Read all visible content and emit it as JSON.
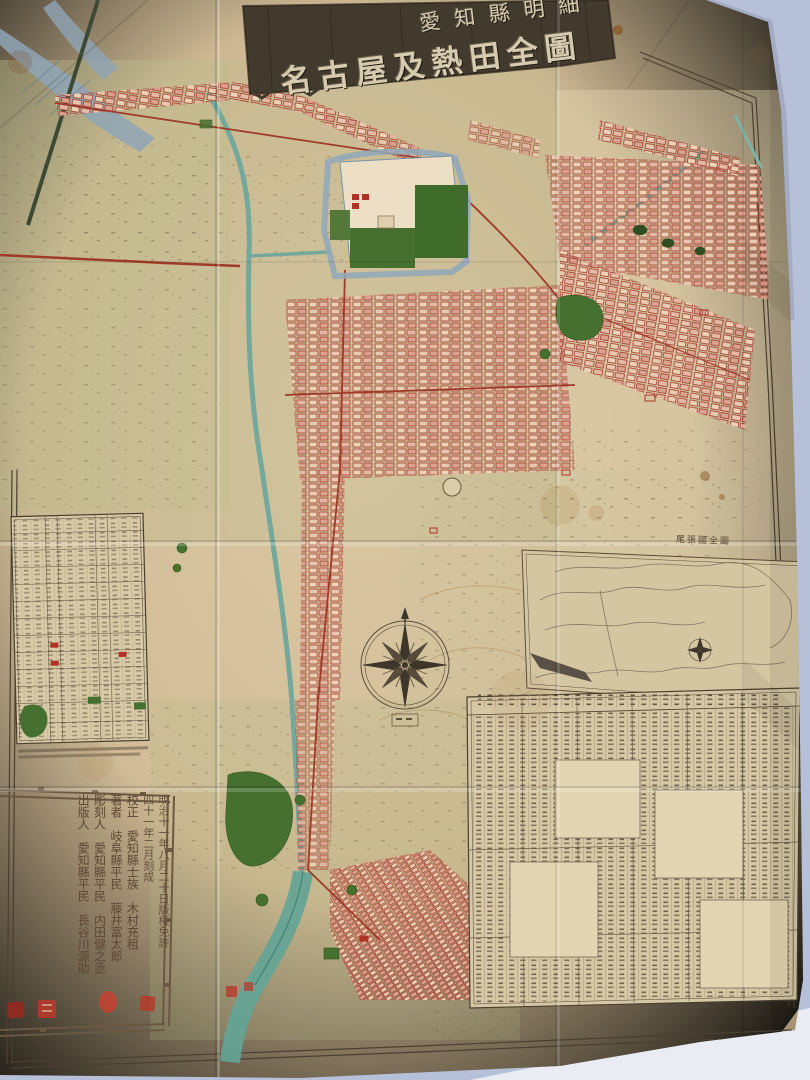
{
  "photo": {
    "backdrop_color": "#b6c0d8",
    "table_surface_color": "#e9edf3",
    "paper_color": "#cdb893"
  },
  "map": {
    "title_banner": {
      "line1": "愛知縣明細",
      "line2": "名古屋及熱田全圖"
    },
    "inset_map": {
      "title": "尾張國全圖"
    },
    "colophon": {
      "columns": [
        "明治十一年八月二十日版権免許",
        "四十一年二月刻成",
        "校正　愛知縣士族　木村充租",
        "著者　岐阜縣平民　藤井富太郎",
        "彫刻人　愛知縣平民　内田健之丞",
        "出版人　愛知縣平民　長谷川源助"
      ]
    },
    "palette": {
      "seal_red": "#b5392b",
      "block_red": "#a43b2c",
      "park_green": "#46702f",
      "river_teal": "#6fa89a",
      "river_slate": "#8ea4b6",
      "ink": "#4a3f30",
      "plaque": "#3f362b"
    }
  }
}
